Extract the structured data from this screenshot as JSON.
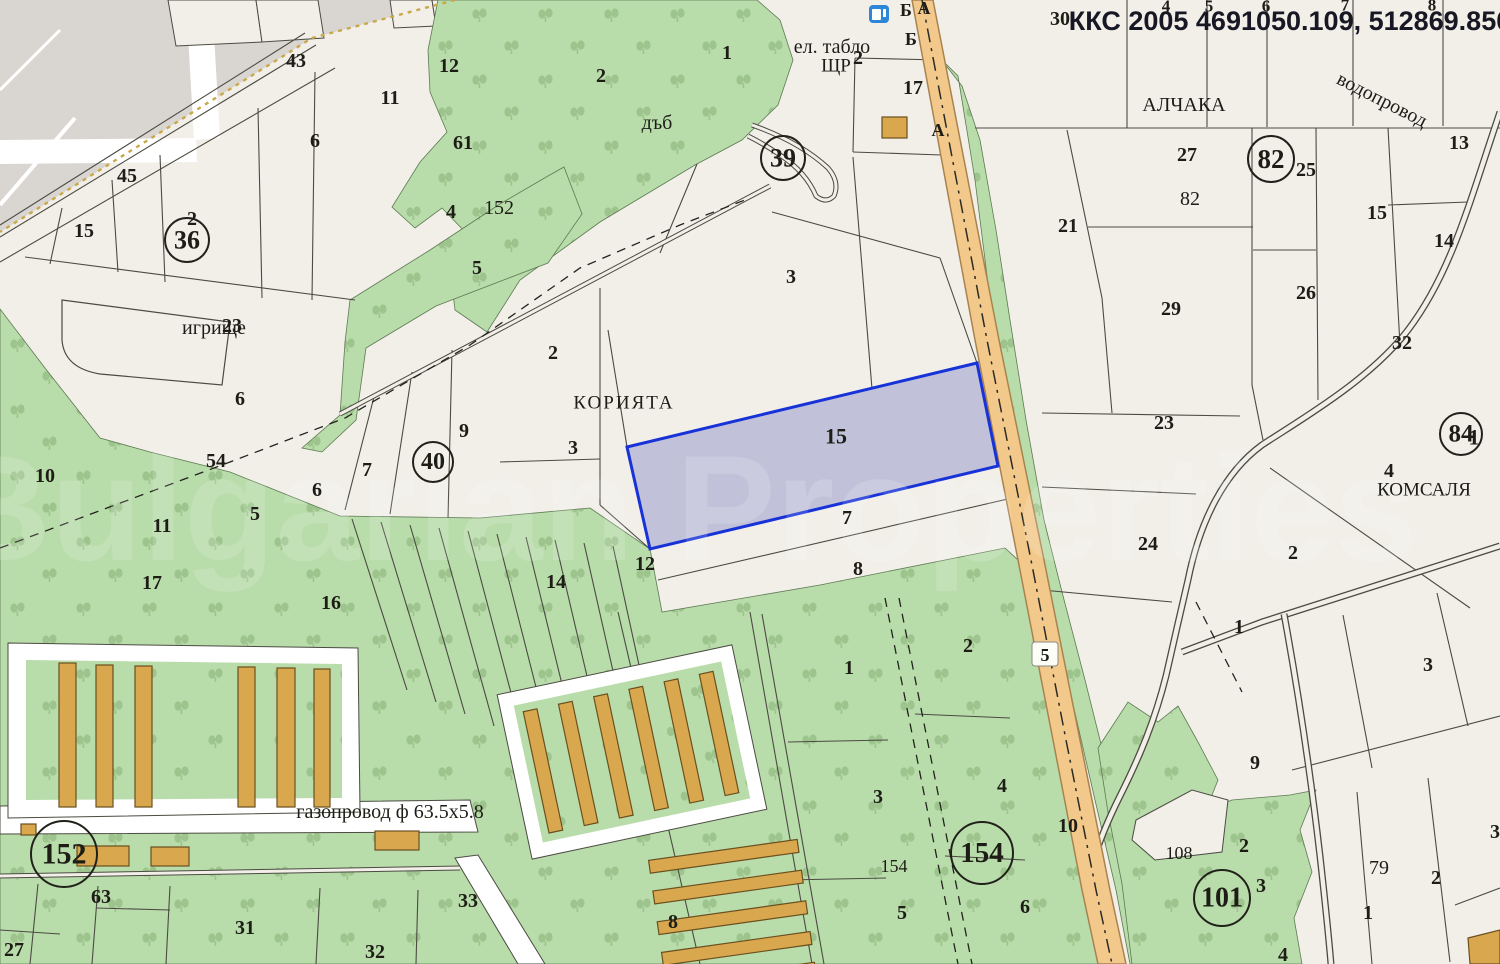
{
  "header": {
    "coordinates_label": "ККС 2005 4691050.109, 512869.850"
  },
  "watermark": {
    "text": "Bulgarian Properties"
  },
  "road": {
    "badge": "5"
  },
  "colors": {
    "background": "#f2efe9",
    "green": "#b9dcab",
    "green_symbol": "#9cc48c",
    "gray_urban": "#d9d6d2",
    "road_fill": "#f3c98b",
    "road_border": "#a8834f",
    "building": "#d9a84e",
    "selected_fill": "#8f96c9",
    "selected_border": "#1733d8",
    "line": "#4b4b42",
    "text": "#1d1d16",
    "boundary_dashed": "#c8a84b"
  },
  "icons": [
    {
      "name": "gas-station-icon"
    }
  ],
  "area_names": [
    "КОРИЯТА",
    "АЛЧАКА",
    "КОМСАЛЯ",
    "дъб",
    "игрище",
    "водопровод",
    "ел. табло",
    "ЩР",
    "газопровод ф 63.5х5.8"
  ],
  "labels": [
    {
      "t": "43",
      "x": 296,
      "y": 61
    },
    {
      "t": "12",
      "x": 449,
      "y": 66
    },
    {
      "t": "11",
      "x": 390,
      "y": 98
    },
    {
      "t": "6",
      "x": 315,
      "y": 141
    },
    {
      "t": "61",
      "x": 463,
      "y": 143
    },
    {
      "t": "45",
      "x": 127,
      "y": 176
    },
    {
      "t": "15",
      "x": 84,
      "y": 231
    },
    {
      "t": "2",
      "x": 192,
      "y": 219
    },
    {
      "t": "4",
      "x": 451,
      "y": 212
    },
    {
      "t": "152",
      "x": 499,
      "y": 208,
      "b": 0
    },
    {
      "t": "5",
      "x": 477,
      "y": 268
    },
    {
      "t": "2",
      "x": 601,
      "y": 76
    },
    {
      "t": "дъб",
      "x": 657,
      "y": 123,
      "b": 0
    },
    {
      "t": "1",
      "x": 727,
      "y": 53
    },
    {
      "t": "игрище",
      "x": 214,
      "y": 328,
      "b": 0
    },
    {
      "t": "23",
      "x": 232,
      "y": 326
    },
    {
      "t": "3",
      "x": 791,
      "y": 277
    },
    {
      "t": "17",
      "x": 913,
      "y": 88
    },
    {
      "t": "ел. табло",
      "x": 832,
      "y": 47,
      "b": 0
    },
    {
      "t": "ЩР",
      "x": 836,
      "y": 66,
      "b": 0,
      "fs": 19
    },
    {
      "t": "2",
      "x": 858,
      "y": 58
    },
    {
      "t": "Б",
      "x": 906,
      "y": 10,
      "fs": 18
    },
    {
      "t": "А",
      "x": 924,
      "y": 8,
      "fs": 18
    },
    {
      "t": "Б",
      "x": 911,
      "y": 39,
      "fs": 18
    },
    {
      "t": "А",
      "x": 938,
      "y": 130,
      "fs": 18
    },
    {
      "t": "2",
      "x": 553,
      "y": 353
    },
    {
      "t": "КОРИЯТА",
      "x": 624,
      "y": 403,
      "b": 0,
      "fs": 19,
      "ls": 2
    },
    {
      "t": "9",
      "x": 464,
      "y": 431
    },
    {
      "t": "3",
      "x": 573,
      "y": 448
    },
    {
      "t": "7",
      "x": 367,
      "y": 470
    },
    {
      "t": "6",
      "x": 317,
      "y": 490
    },
    {
      "t": "5",
      "x": 255,
      "y": 514
    },
    {
      "t": "54",
      "x": 216,
      "y": 461
    },
    {
      "t": "6",
      "x": 240,
      "y": 399
    },
    {
      "t": "10",
      "x": 45,
      "y": 476
    },
    {
      "t": "11",
      "x": 162,
      "y": 526
    },
    {
      "t": "17",
      "x": 152,
      "y": 583
    },
    {
      "t": "16",
      "x": 331,
      "y": 603
    },
    {
      "t": "14",
      "x": 556,
      "y": 582
    },
    {
      "t": "12",
      "x": 645,
      "y": 564
    },
    {
      "t": "15",
      "x": 836,
      "y": 436,
      "fs": 22
    },
    {
      "t": "7",
      "x": 847,
      "y": 518
    },
    {
      "t": "8",
      "x": 858,
      "y": 569
    },
    {
      "t": "1",
      "x": 849,
      "y": 668
    },
    {
      "t": "2",
      "x": 968,
      "y": 646
    },
    {
      "t": "3",
      "x": 878,
      "y": 797
    },
    {
      "t": "154",
      "x": 894,
      "y": 866,
      "b": 0,
      "fs": 18
    },
    {
      "t": "5",
      "x": 902,
      "y": 913
    },
    {
      "t": "4",
      "x": 1002,
      "y": 786
    },
    {
      "t": "6",
      "x": 1025,
      "y": 907
    },
    {
      "t": "10",
      "x": 1068,
      "y": 826
    },
    {
      "t": "8",
      "x": 673,
      "y": 922
    },
    {
      "t": "30",
      "x": 1060,
      "y": 19
    },
    {
      "t": "4",
      "x": 1166,
      "y": 6,
      "fs": 17
    },
    {
      "t": "5",
      "x": 1209,
      "y": 6,
      "fs": 17
    },
    {
      "t": "6",
      "x": 1266,
      "y": 6,
      "fs": 17
    },
    {
      "t": "7",
      "x": 1345,
      "y": 5,
      "fs": 17
    },
    {
      "t": "8",
      "x": 1432,
      "y": 5,
      "fs": 17
    },
    {
      "t": "АЛЧАКА",
      "x": 1184,
      "y": 105,
      "b": 0
    },
    {
      "t": "водопровод",
      "x": 1382,
      "y": 100,
      "b": 0,
      "rot": 27
    },
    {
      "t": "27",
      "x": 1187,
      "y": 155
    },
    {
      "t": "25",
      "x": 1306,
      "y": 170
    },
    {
      "t": "13",
      "x": 1459,
      "y": 143
    },
    {
      "t": "82",
      "x": 1190,
      "y": 199,
      "b": 0
    },
    {
      "t": "21",
      "x": 1068,
      "y": 226
    },
    {
      "t": "15",
      "x": 1377,
      "y": 213
    },
    {
      "t": "14",
      "x": 1444,
      "y": 241
    },
    {
      "t": "26",
      "x": 1306,
      "y": 293
    },
    {
      "t": "29",
      "x": 1171,
      "y": 309
    },
    {
      "t": "32",
      "x": 1402,
      "y": 343
    },
    {
      "t": "23",
      "x": 1164,
      "y": 423
    },
    {
      "t": "24",
      "x": 1148,
      "y": 544
    },
    {
      "t": "1",
      "x": 1474,
      "y": 437,
      "fs": 22
    },
    {
      "t": "4",
      "x": 1389,
      "y": 471
    },
    {
      "t": "КОМСАЛЯ",
      "x": 1424,
      "y": 490,
      "b": 0,
      "fs": 19
    },
    {
      "t": "2",
      "x": 1293,
      "y": 553
    },
    {
      "t": "1",
      "x": 1239,
      "y": 627
    },
    {
      "t": "3",
      "x": 1428,
      "y": 665
    },
    {
      "t": "9",
      "x": 1255,
      "y": 763
    },
    {
      "t": "108",
      "x": 1179,
      "y": 853,
      "b": 0,
      "fs": 18
    },
    {
      "t": "2",
      "x": 1244,
      "y": 846
    },
    {
      "t": "3",
      "x": 1261,
      "y": 886
    },
    {
      "t": "79",
      "x": 1379,
      "y": 868,
      "b": 0
    },
    {
      "t": "1",
      "x": 1368,
      "y": 913
    },
    {
      "t": "2",
      "x": 1436,
      "y": 878
    },
    {
      "t": "3",
      "x": 1495,
      "y": 832
    },
    {
      "t": "4",
      "x": 1283,
      "y": 955
    },
    {
      "t": "газопровод ф 63.5х5.8",
      "x": 390,
      "y": 812,
      "b": 0
    },
    {
      "t": "63",
      "x": 101,
      "y": 897
    },
    {
      "t": "31",
      "x": 245,
      "y": 928
    },
    {
      "t": "32",
      "x": 375,
      "y": 952
    },
    {
      "t": "33",
      "x": 468,
      "y": 901
    },
    {
      "t": "27",
      "x": 14,
      "y": 950
    }
  ],
  "circled_numbers": [
    {
      "t": "36",
      "x": 187,
      "y": 240,
      "r": 22,
      "fs": 26
    },
    {
      "t": "39",
      "x": 783,
      "y": 158,
      "r": 22,
      "fs": 26
    },
    {
      "t": "40",
      "x": 433,
      "y": 462,
      "r": 20,
      "fs": 24
    },
    {
      "t": "82",
      "x": 1271,
      "y": 159,
      "r": 23,
      "fs": 27
    },
    {
      "t": "84",
      "x": 1461,
      "y": 434,
      "r": 21,
      "fs": 25
    },
    {
      "t": "152",
      "x": 64,
      "y": 854,
      "r": 33,
      "fs": 30
    },
    {
      "t": "154",
      "x": 982,
      "y": 853,
      "r": 31,
      "fs": 29
    },
    {
      "t": "101",
      "x": 1222,
      "y": 898,
      "r": 28,
      "fs": 28
    }
  ]
}
